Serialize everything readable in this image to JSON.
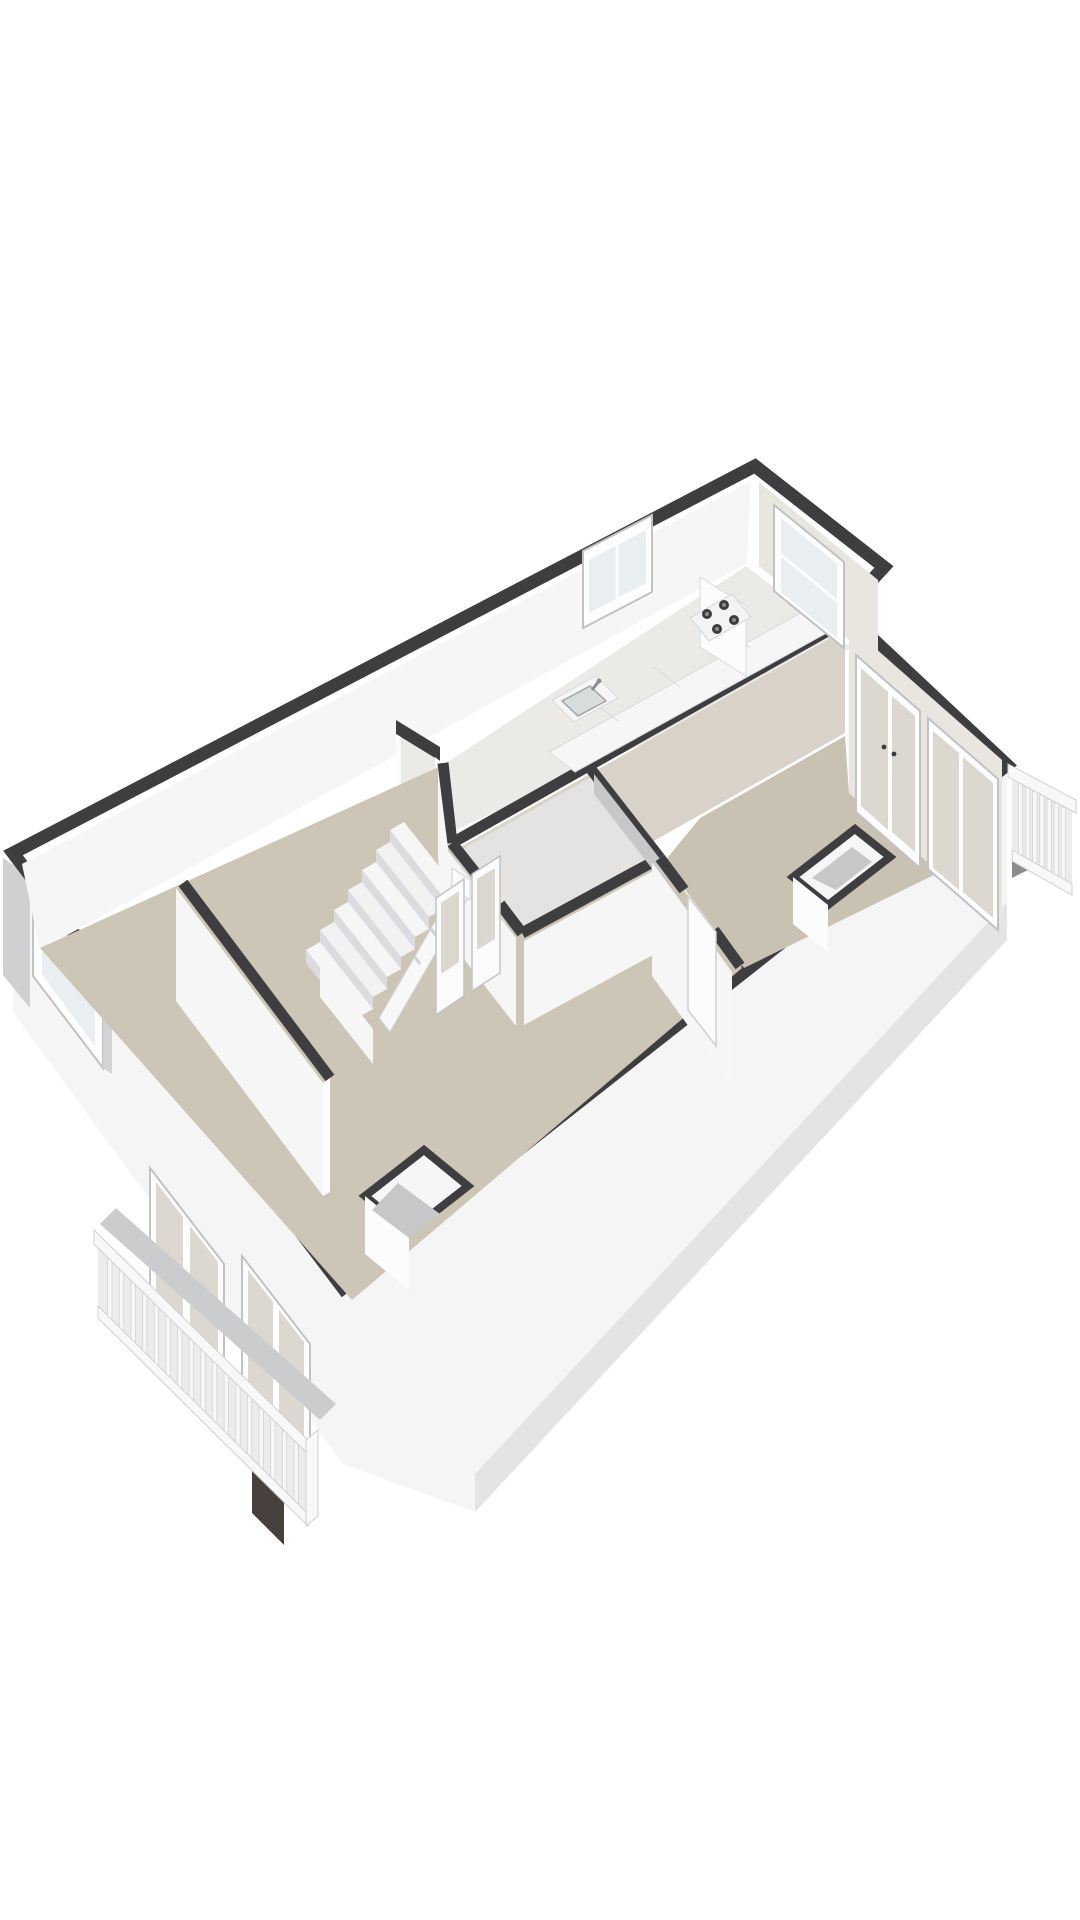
{
  "scene": {
    "kind": "3d-floorplan-axonometric-render",
    "background": "#ffffff",
    "rooms": [
      "living-room",
      "hall-stairs",
      "bathroom",
      "kitchen",
      "bedroom"
    ],
    "fixtures": [
      "staircase",
      "kitchen-counter",
      "stove",
      "sink",
      "front-door",
      "radiator",
      "balcony-southwest",
      "balcony-northeast",
      "french-doors",
      "windows",
      "duct-shafts"
    ]
  },
  "colors": {
    "bg": "#ffffff",
    "band": "#3e3e40",
    "bandSoft": "#4a4a4c",
    "wallWhite": "#f6f6f7",
    "wallBright": "#fcfcfd",
    "wallShade": "#d2d3d5",
    "wallGray": "#c6c7c9",
    "wallWarm": "#d8d2c8",
    "wallWarmLight": "#e9e6e0",
    "facadeWhite": "#f5f5f6",
    "facadeEdge": "#e4e4e6",
    "facadeGray": "#cfd0d2",
    "floorLiving": "#cdc5b6",
    "floorBedroom": "#c9c2b3",
    "floorKitchen": "#eceae7",
    "floorBath": "#e4e3e1",
    "balconyFloor": "#cbccce",
    "railFill": "#ececee",
    "railBar": "#f8f8f9",
    "railStroke": "#cfd1d3",
    "picket": "#f7f7f9",
    "picketStroke": "#cdcfd1",
    "frame": "#fdfdfe",
    "frameStroke": "#c0c3c5",
    "glass": "#e9eef0",
    "glassWarm": "#ddd8cf",
    "counterTop": "#f6f6f7",
    "counterStroke": "#d8dadb",
    "stoveBody": "#f3f3f4",
    "burner": "#3b3b3d",
    "burnerRing": "#8a8c8e",
    "sinkBasin": "#d9dcdd",
    "sinkStroke": "#9fa2a4",
    "stepTop": "#f2f2f3",
    "stepRiser": "#dcdce0",
    "doorBrown": "#7c4030",
    "doorBrownDark": "#5f2f22",
    "radiator": "#2e2e30",
    "shadowDark": "#47403c",
    "doorLeaf": "#fbfbfc"
  },
  "railings": {
    "southwest": {
      "pickets": 17
    },
    "northeast": {
      "pickets": 7
    }
  },
  "stairs": {
    "steps": 7
  },
  "stove": {
    "burners": 4
  }
}
